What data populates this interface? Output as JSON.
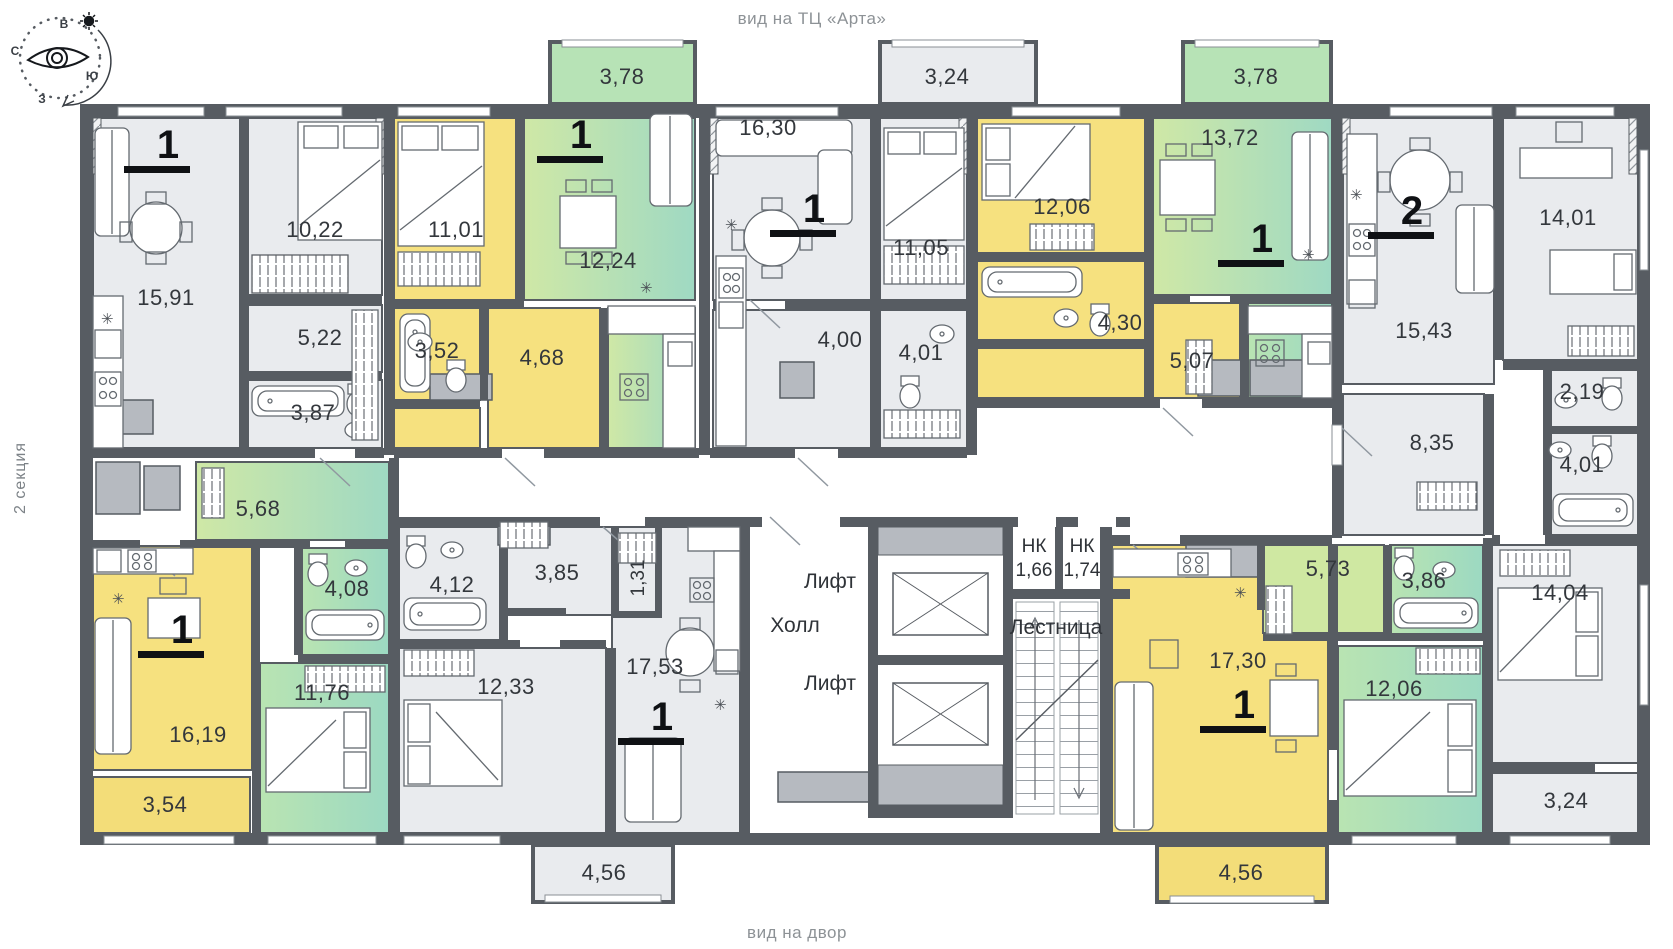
{
  "captions": {
    "top": "вид на ТЦ «Арта»",
    "bottom": "вид на двор",
    "section": "2 секция"
  },
  "compass": {
    "north": "С",
    "east": "В",
    "south": "Ю",
    "west": "З"
  },
  "core": {
    "hall_label": "Холл",
    "lift_label": "Лифт",
    "stairs_label": "Лестница",
    "nk_label": "НК",
    "nk1_area": "1,66",
    "nk2_area": "1,74"
  },
  "icons": {
    "snowflake": "✳"
  },
  "apartments": {
    "apt1": {
      "type": "1",
      "living": "15,91",
      "bedroom": "10,22",
      "hall": "5,22",
      "bath": "3,87"
    },
    "apt2": {
      "type": "1",
      "bedroom": "11,01",
      "bath": "3,52",
      "hall": "4,68",
      "living": "12,24",
      "balcony": "3,78"
    },
    "apt3": {
      "type": "1",
      "living": "16,30",
      "bedroom": "11,05",
      "hall": "4,00",
      "bath": "4,01",
      "balcony": "3,24"
    },
    "apt4": {
      "type": "1",
      "bedroom": "12,06",
      "bath": "4,30",
      "hall": "5,07",
      "living": "13,72",
      "balcony": "3,78"
    },
    "apt5": {
      "type": "2",
      "living": "15,43",
      "bedroom1": "14,01",
      "wc": "2,19",
      "hall": "8,35",
      "bath": "4,01",
      "bedroom2": "14,04",
      "balcony": "3,24"
    },
    "apt6": {
      "type": "1",
      "hall": "5,68",
      "bath": "4,08",
      "living": "16,19",
      "bedroom": "11,76",
      "balcony": "3,54"
    },
    "apt7": {
      "type": "1",
      "bath": "4,12",
      "hall": "3,85",
      "wardrobe": "1,31",
      "bedroom": "12,33",
      "living": "17,53",
      "balcony": "4,56"
    },
    "apt8": {
      "type": "1",
      "living": "17,30",
      "hall": "5,73",
      "bath": "3,86",
      "bedroom": "12,06",
      "balcony": "4,56"
    }
  },
  "colors": {
    "wall": "#575c62",
    "yellow": "#f6e17f",
    "green": "#aedcba",
    "gray_room": "#e9ebee"
  }
}
